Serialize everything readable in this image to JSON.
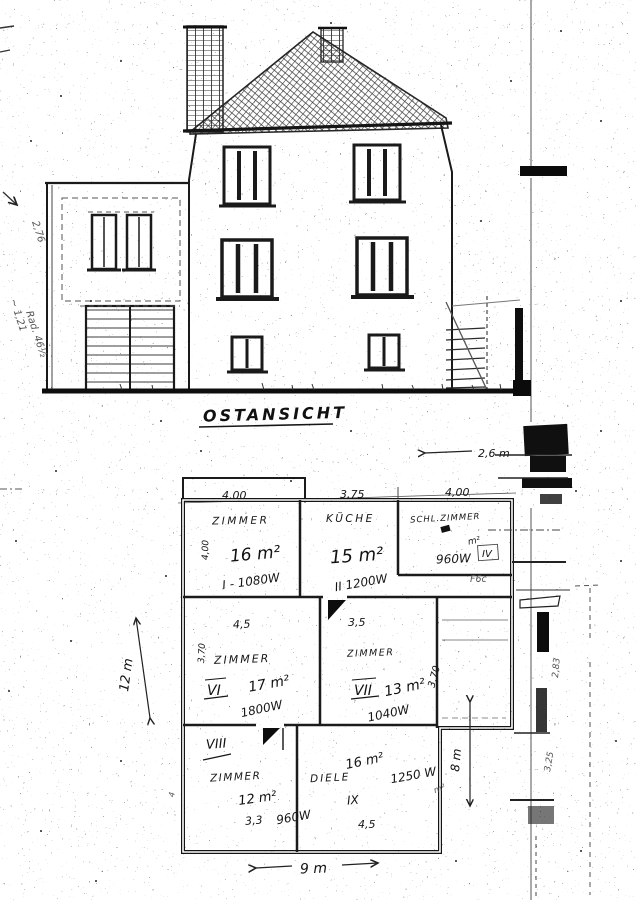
{
  "document": {
    "type_label": "OSTANSICHT"
  },
  "margin_notes": {
    "a": "2,76",
    "b": "~ 1,21",
    "c": "Rad. 46½"
  },
  "plan": {
    "top_dims": [
      "4,00",
      "3,75",
      "4,00"
    ],
    "upper_right_dim": "2,6 m",
    "rooms": {
      "zimmer_i": {
        "name": "ZIMMER",
        "area": "16 m²",
        "circuit": "I - 1080W",
        "side_dim": "4,00"
      },
      "kueche": {
        "name": "KÜCHE",
        "area": "15 m²",
        "circuit": "II 1200W"
      },
      "schlafzimmer": {
        "name": "SCHL.ZIMMER",
        "area_mark": "m²",
        "circuit": "960W",
        "numeral": "IV",
        "corridor_note": "F6c"
      },
      "zimmer_vi": {
        "name": "ZIMMER",
        "numeral": "VI",
        "area": "17 m²",
        "circuit": "1800W",
        "top_dim": "4,5",
        "side_dim": "3,70"
      },
      "zimmer_vii": {
        "name": "ZIMMER",
        "numeral": "VII",
        "area": "13 m²",
        "circuit": "1040W",
        "top_dim": "3,5",
        "side_dim": "3,70"
      },
      "zimmer_viii": {
        "name": "ZIMMER",
        "numeral": "VIII",
        "area": "12 m²",
        "circuit": "960W",
        "bottom_dim": "3,3",
        "edge_mark": "4"
      },
      "diele": {
        "name": "DIELE",
        "numeral": "IX",
        "area": "16 m²",
        "circuit": "1250 W",
        "bottom_dim": "4,5",
        "stray_mark": "m²"
      }
    },
    "overall_dims": {
      "left": "12 m",
      "bottom": "9 m",
      "right": "8 m"
    },
    "strip_dims": [
      "2,83",
      "3,25"
    ]
  }
}
